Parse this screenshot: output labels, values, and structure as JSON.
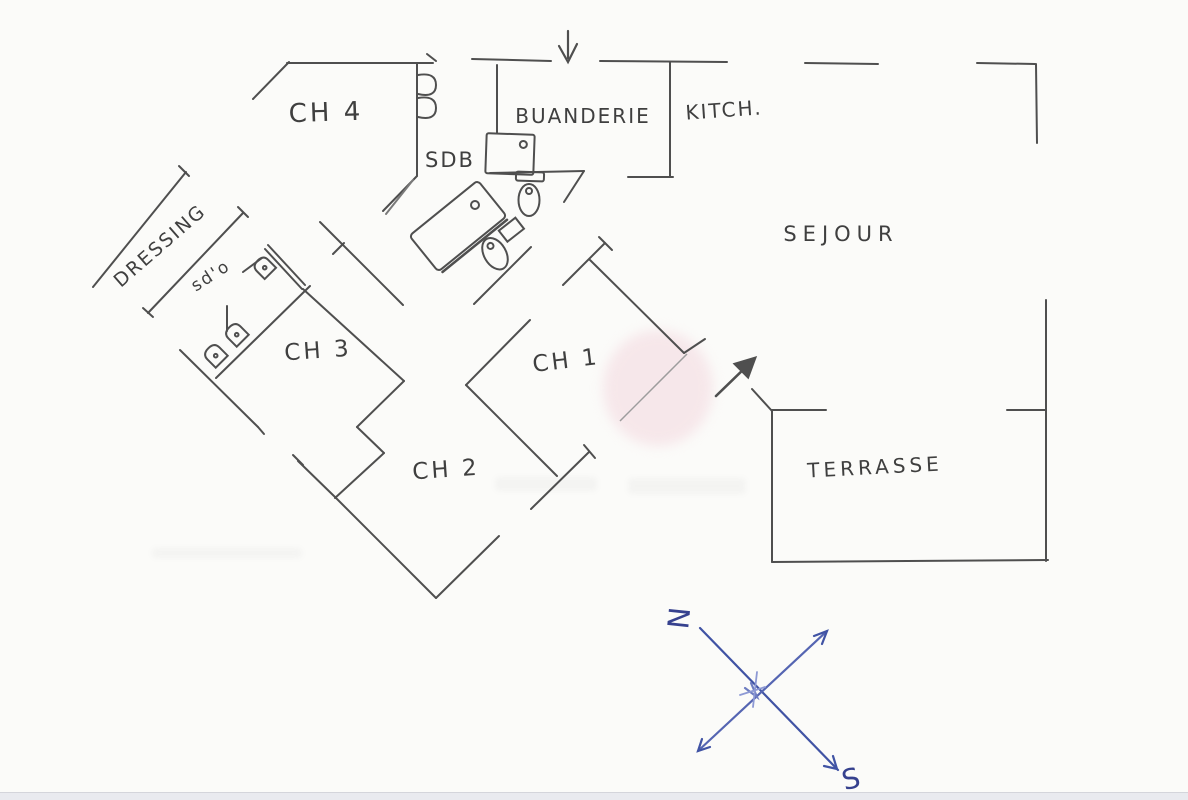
{
  "document": {
    "type": "hand-drawn floor plan sketch",
    "paper_color": "#fbfbf9",
    "ink_color": "#4f4f4f",
    "compass_color": "#4053a4",
    "watermark_pink": "#f3d7de",
    "bottom_bar_color": "#e9eaef"
  },
  "rooms": {
    "ch4": {
      "label": "CH 4"
    },
    "sdb": {
      "label": "SDB"
    },
    "buanderie": {
      "label": "BUANDERIE"
    },
    "kitchen": {
      "label": "KITCH."
    },
    "sejour": {
      "label": "SEJOUR"
    },
    "dressing": {
      "label": "DRESSING"
    },
    "sdo": {
      "label": "sd'o"
    },
    "ch3": {
      "label": "CH 3"
    },
    "ch2": {
      "label": "CH 2"
    },
    "ch1": {
      "label": "CH 1"
    },
    "terrasse": {
      "label": "TERRASSE"
    }
  },
  "compass": {
    "north_label": "N",
    "south_label": "S"
  }
}
